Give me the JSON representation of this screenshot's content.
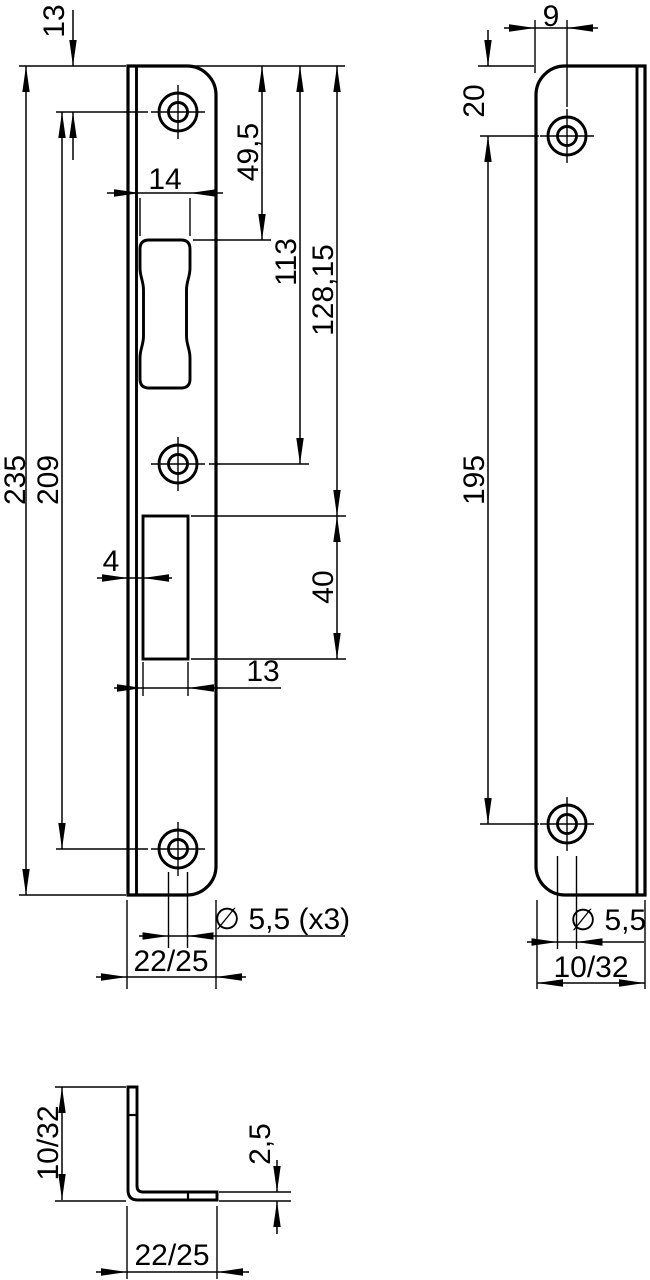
{
  "dimensions": {
    "front_view": {
      "hole_top_offset": "13",
      "total_height": "235",
      "hole_spacing": "209",
      "latch_cutout_width": "14",
      "top_to_latch_cutout": "49,5",
      "top_to_middle_hole": "113",
      "top_to_bolt_cutout": "128,15",
      "bolt_cutout_height": "40",
      "bolt_cutout_offset": "4",
      "bolt_cutout_width": "13",
      "hole_diameter": "∅ 5,5 (x3)",
      "plate_width": "22/25"
    },
    "side_view": {
      "hole_to_edge": "9",
      "top_to_hole": "20",
      "hole_spacing": "195",
      "hole_diameter": "∅ 5,5",
      "leg_width": "10/32"
    },
    "profile_view": {
      "leg_height": "10/32",
      "material_thickness": "2,5",
      "flange_width": "22/25"
    }
  },
  "colors": {
    "line": "#000000",
    "background": "#ffffff"
  }
}
